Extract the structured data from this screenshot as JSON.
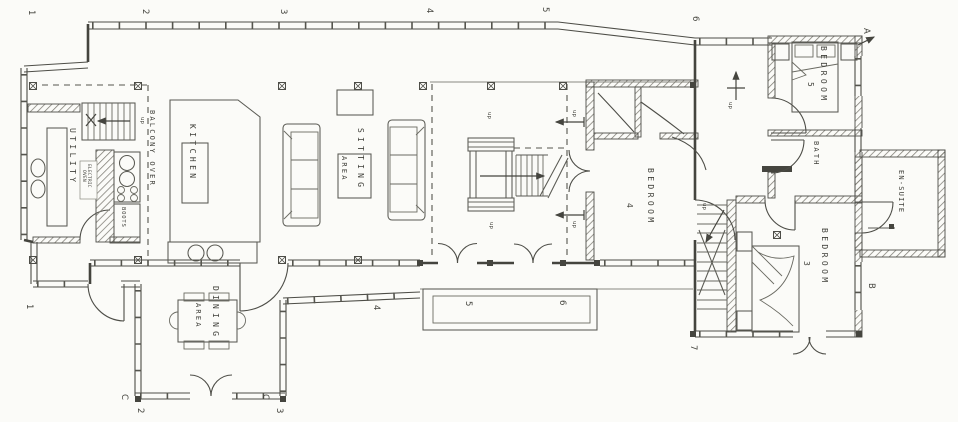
{
  "palette": {
    "paper": "#fbfbf8",
    "ink": "#45453f",
    "light": "#8a8a82"
  },
  "rooms": {
    "utility": {
      "label": "UTILITY"
    },
    "kitchen": {
      "label": "KITCHEN"
    },
    "balcony": {
      "label": "BALCONY OVER"
    },
    "sitting": {
      "line1": "SITTING",
      "line2": "AREA"
    },
    "dining": {
      "line1": "DINING",
      "line2": "AREA"
    },
    "bedroom4": {
      "label": "BEDROOM",
      "number": "4"
    },
    "bedroom5": {
      "label": "BEDROOM",
      "number": "5"
    },
    "bedroom3": {
      "label": "BEDROOM",
      "number": "3"
    },
    "bath": {
      "label": "BATH"
    },
    "ensuite": {
      "label": "EN-SUITE"
    }
  },
  "fixtures": {
    "boots": "BOOTS",
    "electric": "ELECTRIC",
    "oven": "OVEN"
  },
  "annotations": {
    "up": "up"
  },
  "grid": {
    "g1": "1",
    "g2": "2",
    "g3": "3",
    "g4": "4",
    "g5": "5",
    "g6": "6",
    "g7": "7",
    "gA": "A",
    "gB": "B",
    "gC": "C"
  }
}
